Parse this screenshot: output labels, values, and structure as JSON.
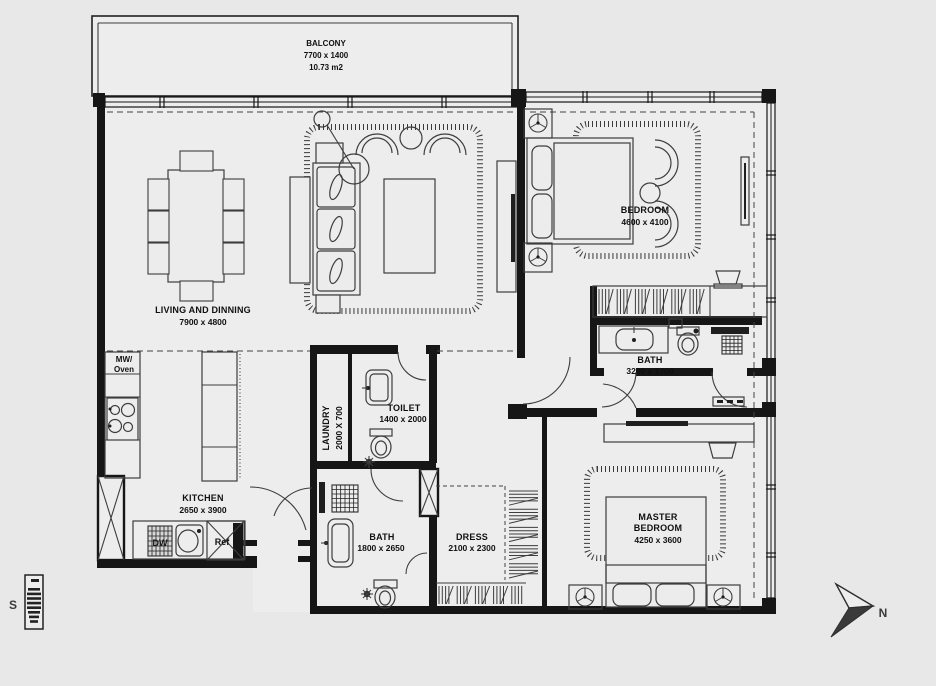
{
  "title": "Apartment floor plan",
  "rooms": {
    "balcony": {
      "name": "BALCONY",
      "dims": "7700 x 1400",
      "area": "10.73 m2"
    },
    "living": {
      "name": "LIVING AND DINNING",
      "dims": "7900 x 4800"
    },
    "bedroom": {
      "name": "BEDROOM",
      "dims": "4600 x 4100"
    },
    "bath1": {
      "name": "BATH",
      "dims": "3200 x 1700"
    },
    "kitchen": {
      "name": "KITCHEN",
      "dims": "2650 x 3900"
    },
    "laundry": {
      "name": "LAUNDRY",
      "dims": "2000 X 700"
    },
    "toilet": {
      "name": "TOILET",
      "dims": "1400 x 2000"
    },
    "bath2": {
      "name": "BATH",
      "dims": "1800 x 2650"
    },
    "dress": {
      "name": "DRESS",
      "dims": "2100 x 2300"
    },
    "master": {
      "name_line1": "MASTER",
      "name_line2": "BEDROOM",
      "dims": "4250 x 3600"
    }
  },
  "appliances": {
    "mw_line1": "MW/",
    "mw_line2": "Oven",
    "dishwasher": "DW",
    "fridge": "Ref"
  },
  "compass": {
    "south_label": "S",
    "north_label": "N"
  },
  "colors": {
    "background": "#e8e8e8",
    "floor": "#ededed",
    "wall": "#161616",
    "furniture_line": "#3d3d3d",
    "text": "#101010"
  }
}
